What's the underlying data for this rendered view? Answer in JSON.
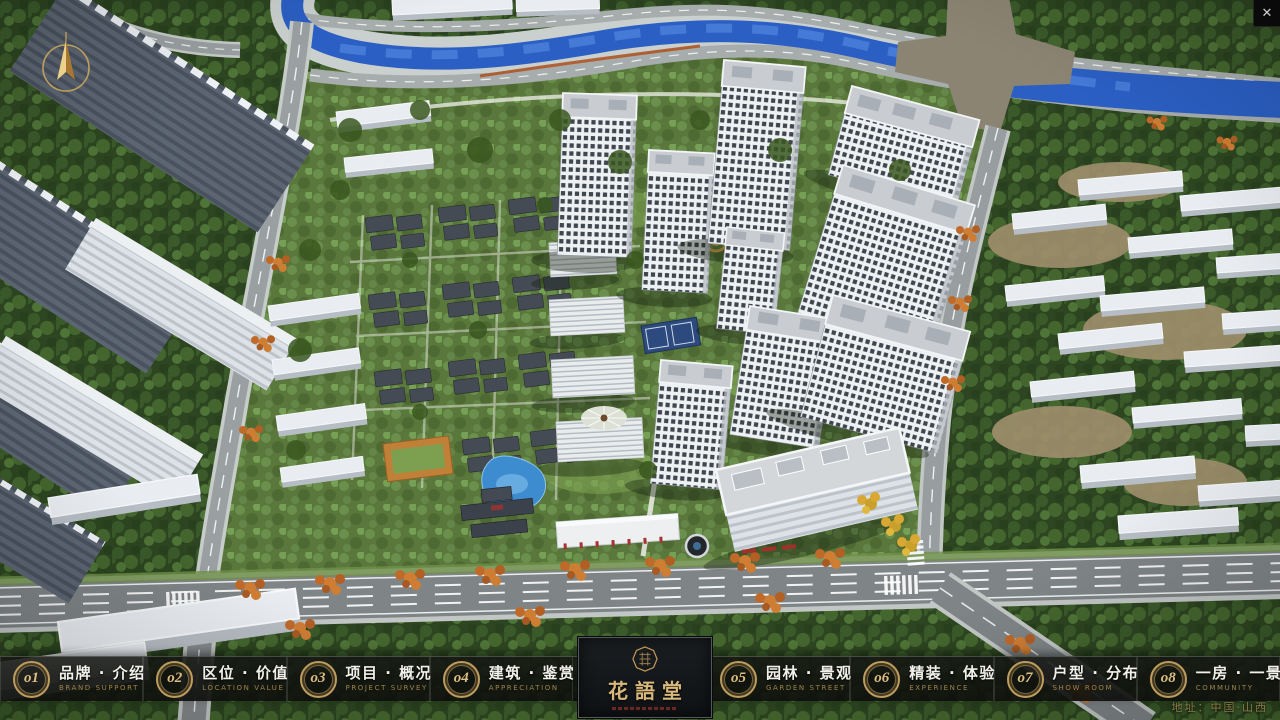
{
  "colors": {
    "accent_gold": "#bd9c5e",
    "text_gold": "#9a8348",
    "chinese_white": "#f1f0ea",
    "river_blue": "#2b5fc4",
    "panel_bg": "#14171a"
  },
  "nav": {
    "items": [
      {
        "number": "o1",
        "label": "品牌 · 介绍",
        "sublabel": "BRAND SUPPORT"
      },
      {
        "number": "o2",
        "label": "区位 · 价值",
        "sublabel": "LOCATION VALUE"
      },
      {
        "number": "o3",
        "label": "项目 · 概况",
        "sublabel": "PROJECT SURVEY"
      },
      {
        "number": "o4",
        "label": "建筑 · 鉴赏",
        "sublabel": "APPRECIATION"
      },
      {
        "number": "o5",
        "label": "园林 · 景观",
        "sublabel": "GARDEN STREET"
      },
      {
        "number": "o6",
        "label": "精装 · 体验",
        "sublabel": "EXPERIENCE"
      },
      {
        "number": "o7",
        "label": "户型 · 分布",
        "sublabel": "SHOW ROOM"
      },
      {
        "number": "o8",
        "label": "一房 · 一景",
        "sublabel": "COMMUNITY"
      }
    ]
  },
  "logo": {
    "title": "花語堂"
  },
  "footer": {
    "address": "地址：中国·山西"
  },
  "window": {
    "close_label": "✕"
  }
}
